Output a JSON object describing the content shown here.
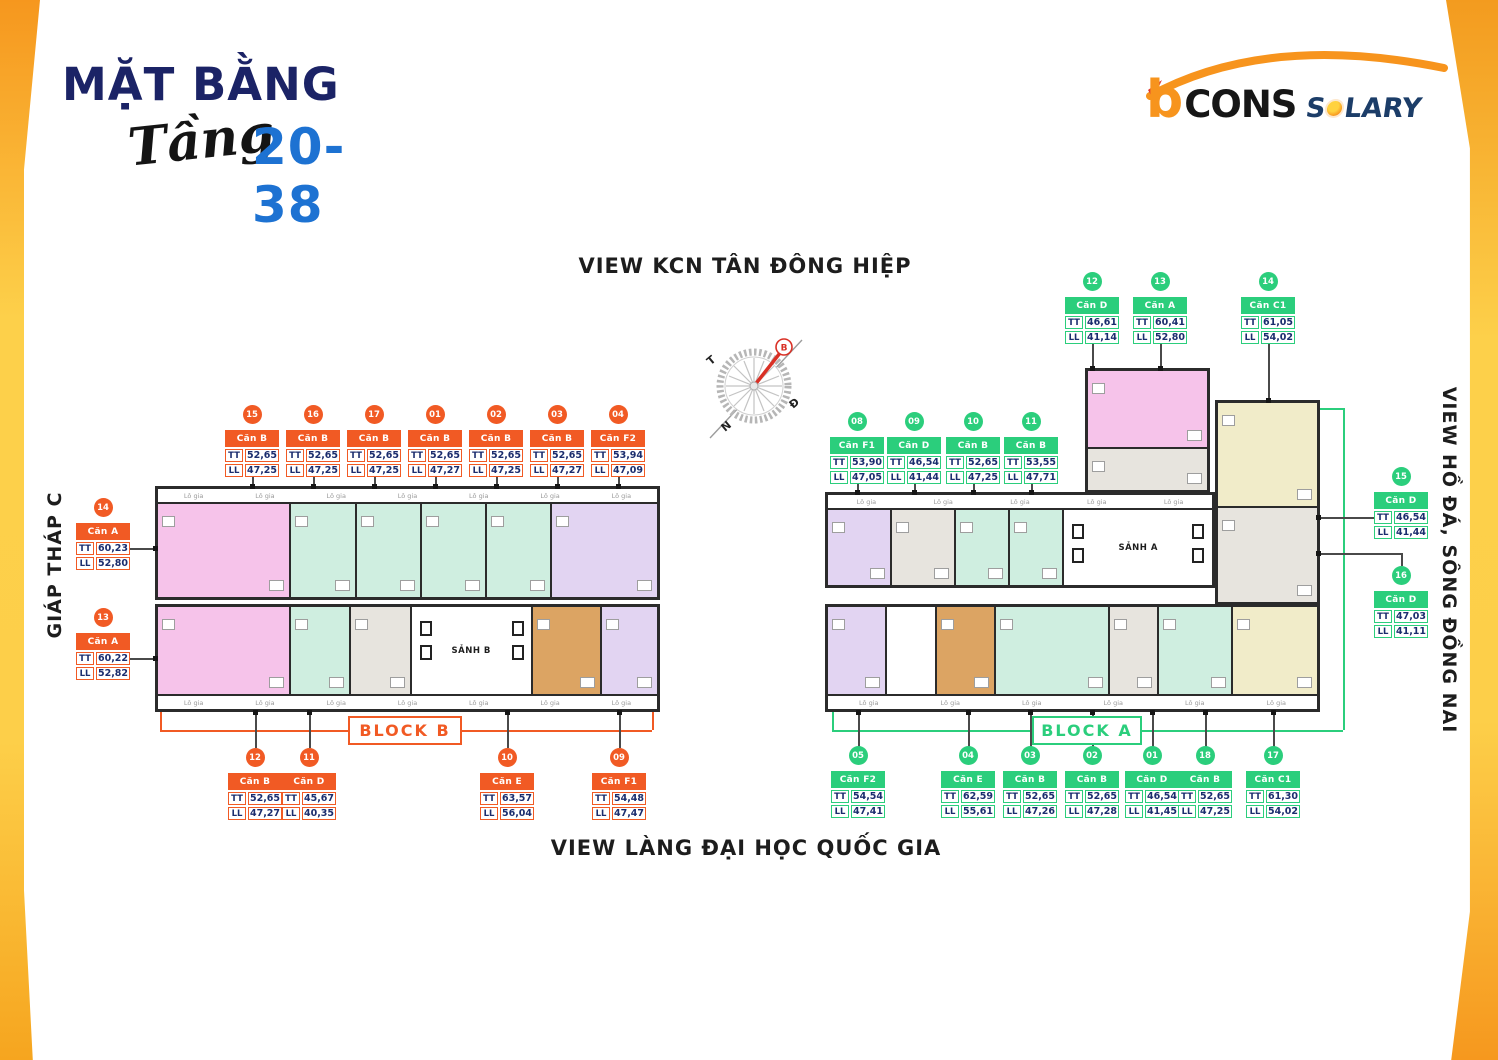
{
  "header": {
    "title": "MẶT BẰNG",
    "floor_script": "Tầng",
    "floor_range": "20-38"
  },
  "logo": {
    "brand_b": "b",
    "brand_rest": "CONS",
    "suffix_s": "S",
    "suffix_rest": "LARY"
  },
  "views": {
    "top": "VIEW KCN TÂN ĐÔNG HIỆP",
    "bottom": "VIEW LÀNG ĐẠI HỌC QUỐC GIA",
    "left": "GIÁP THÁP C",
    "right": "VIEW HỒ ĐÁ, SÔNG ĐỒNG NAI"
  },
  "compass": {
    "north": "B",
    "west": "T",
    "east": "Đ",
    "south": "N"
  },
  "plan": {
    "balcony_label": "Lô gia",
    "lobby_a": "SẢNH A",
    "lobby_b": "SẢNH B"
  },
  "labels": {
    "tt": "TT",
    "ll": "LL"
  },
  "blocks": {
    "b": {
      "label": "BLOCK B",
      "color": "#F15A24"
    },
    "a": {
      "label": "BLOCK A",
      "color": "#2BCE7C"
    }
  },
  "cards": [
    {
      "id": "b-15",
      "block": "b",
      "num": "15",
      "name": "Căn B",
      "tt": "52,65",
      "ll": "47,25"
    },
    {
      "id": "b-16",
      "block": "b",
      "num": "16",
      "name": "Căn B",
      "tt": "52,65",
      "ll": "47,25"
    },
    {
      "id": "b-17",
      "block": "b",
      "num": "17",
      "name": "Căn B",
      "tt": "52,65",
      "ll": "47,25"
    },
    {
      "id": "b-01",
      "block": "b",
      "num": "01",
      "name": "Căn B",
      "tt": "52,65",
      "ll": "47,27"
    },
    {
      "id": "b-02",
      "block": "b",
      "num": "02",
      "name": "Căn B",
      "tt": "52,65",
      "ll": "47,25"
    },
    {
      "id": "b-03",
      "block": "b",
      "num": "03",
      "name": "Căn B",
      "tt": "52,65",
      "ll": "47,27"
    },
    {
      "id": "b-04",
      "block": "b",
      "num": "04",
      "name": "Căn F2",
      "tt": "53,94",
      "ll": "47,09"
    },
    {
      "id": "b-14",
      "block": "b",
      "num": "14",
      "name": "Căn A",
      "tt": "60,23",
      "ll": "52,80"
    },
    {
      "id": "b-13",
      "block": "b",
      "num": "13",
      "name": "Căn A",
      "tt": "60,22",
      "ll": "52,82"
    },
    {
      "id": "b-12",
      "block": "b",
      "num": "12",
      "name": "Căn B",
      "tt": "52,65",
      "ll": "47,27"
    },
    {
      "id": "b-11",
      "block": "b",
      "num": "11",
      "name": "Căn D",
      "tt": "45,67",
      "ll": "40,35"
    },
    {
      "id": "b-10",
      "block": "b",
      "num": "10",
      "name": "Căn E",
      "tt": "63,57",
      "ll": "56,04"
    },
    {
      "id": "b-09",
      "block": "b",
      "num": "09",
      "name": "Căn F1",
      "tt": "54,48",
      "ll": "47,47"
    },
    {
      "id": "a-08",
      "block": "a",
      "num": "08",
      "name": "Căn F1",
      "tt": "53,90",
      "ll": "47,05"
    },
    {
      "id": "a-09",
      "block": "a",
      "num": "09",
      "name": "Căn D",
      "tt": "46,54",
      "ll": "41,44"
    },
    {
      "id": "a-10",
      "block": "a",
      "num": "10",
      "name": "Căn B",
      "tt": "52,65",
      "ll": "47,25"
    },
    {
      "id": "a-11",
      "block": "a",
      "num": "11",
      "name": "Căn B",
      "tt": "53,55",
      "ll": "47,71"
    },
    {
      "id": "a-12",
      "block": "a",
      "num": "12",
      "name": "Căn D",
      "tt": "46,61",
      "ll": "41,14"
    },
    {
      "id": "a-13",
      "block": "a",
      "num": "13",
      "name": "Căn A",
      "tt": "60,41",
      "ll": "52,80"
    },
    {
      "id": "a-14",
      "block": "a",
      "num": "14",
      "name": "Căn C1",
      "tt": "61,05",
      "ll": "54,02"
    },
    {
      "id": "a-15",
      "block": "a",
      "num": "15",
      "name": "Căn D",
      "tt": "46,54",
      "ll": "41,44"
    },
    {
      "id": "a-16",
      "block": "a",
      "num": "16",
      "name": "Căn D",
      "tt": "47,03",
      "ll": "41,11"
    },
    {
      "id": "a-05",
      "block": "a",
      "num": "05",
      "name": "Căn F2",
      "tt": "54,54",
      "ll": "47,41"
    },
    {
      "id": "a-04",
      "block": "a",
      "num": "04",
      "name": "Căn E",
      "tt": "62,59",
      "ll": "55,61"
    },
    {
      "id": "a-03",
      "block": "a",
      "num": "03",
      "name": "Căn B",
      "tt": "52,65",
      "ll": "47,26"
    },
    {
      "id": "a-02",
      "block": "a",
      "num": "02",
      "name": "Căn B",
      "tt": "52,65",
      "ll": "47,28"
    },
    {
      "id": "a-01",
      "block": "a",
      "num": "01",
      "name": "Căn D",
      "tt": "46,54",
      "ll": "41,45"
    },
    {
      "id": "a-18",
      "block": "a",
      "num": "18",
      "name": "Căn B",
      "tt": "52,65",
      "ll": "47,25"
    },
    {
      "id": "a-17",
      "block": "a",
      "num": "17",
      "name": "Căn C1",
      "tt": "61,30",
      "ll": "54,02"
    }
  ]
}
